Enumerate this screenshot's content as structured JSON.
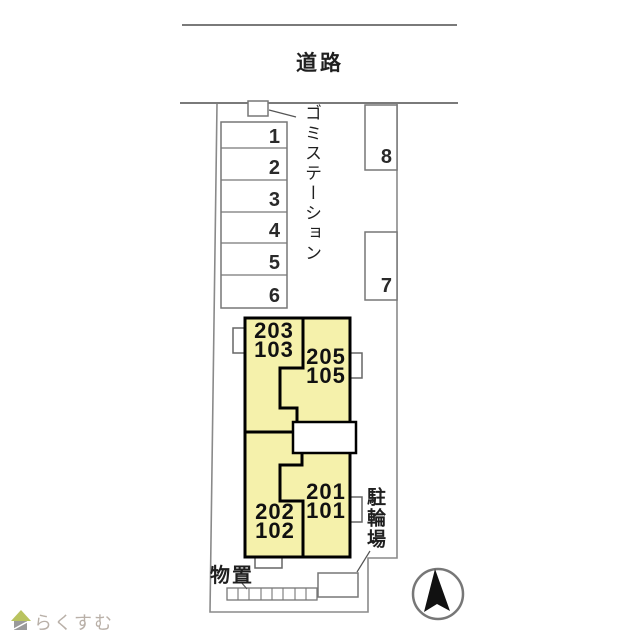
{
  "colors": {
    "building_fill": "#f5f1ab",
    "outline": "#000000",
    "thin_line": "#7d7d7d",
    "text": "#1f1f1f",
    "watermark_text": "#b9b0a8",
    "watermark_roof": "#b9c35f",
    "watermark_body": "#9a9a9a"
  },
  "road": {
    "label": "道路"
  },
  "garbage_station": {
    "label": "ゴミステーション"
  },
  "parking_left": {
    "stalls": [
      "1",
      "2",
      "3",
      "4",
      "5",
      "6"
    ]
  },
  "parking_right": {
    "stalls": [
      "8",
      "7"
    ]
  },
  "building": {
    "units": [
      {
        "name": "203-103",
        "line1": "203",
        "line2": "103"
      },
      {
        "name": "205-105",
        "line1": "205",
        "line2": "105"
      },
      {
        "name": "201-101",
        "line1": "201",
        "line2": "101"
      },
      {
        "name": "202-102",
        "line1": "202",
        "line2": "102"
      }
    ]
  },
  "bicycle_parking": {
    "label": "駐輪場"
  },
  "storage": {
    "label": "物置"
  },
  "watermark": {
    "text": "らくすむ"
  }
}
